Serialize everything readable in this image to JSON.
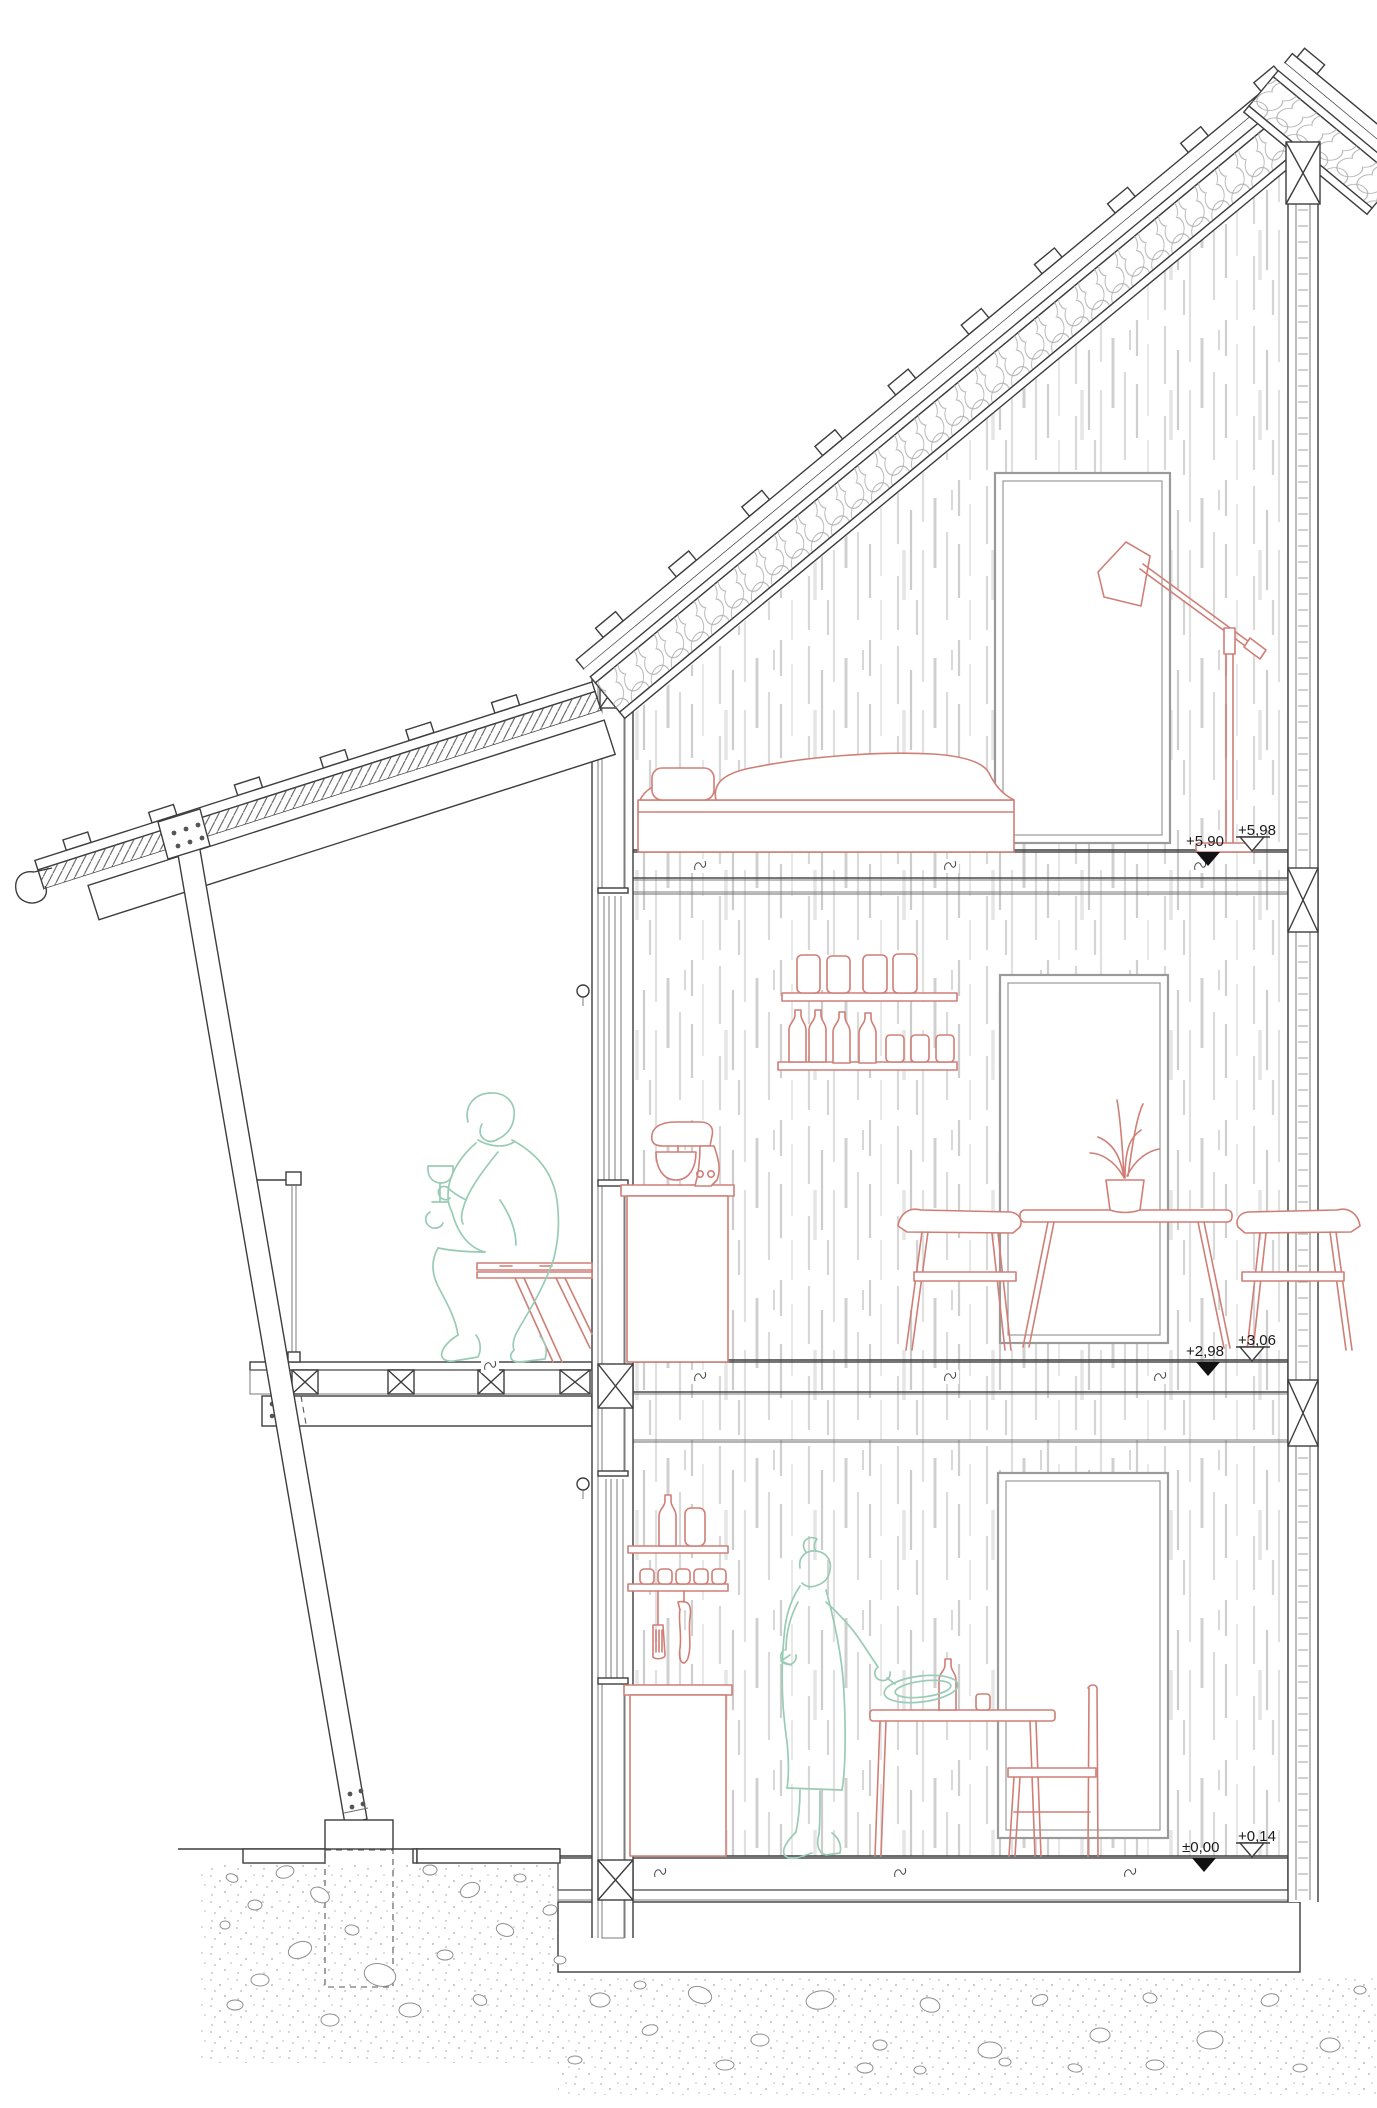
{
  "drawing": {
    "annotations": {
      "upper": {
        "open": "+5,98",
        "filled": "+5,90"
      },
      "middle": {
        "open": "+3,06",
        "filled": "+2,98"
      },
      "ground": {
        "open": "+0,14",
        "filled": "±0,00"
      }
    },
    "colors": {
      "furniture": "#cf7f76",
      "figures": "#9acbb5",
      "linework": "#3d3d3d",
      "window_frame": "#9a9a9a",
      "wall_texture": "#d8d8d8"
    }
  }
}
